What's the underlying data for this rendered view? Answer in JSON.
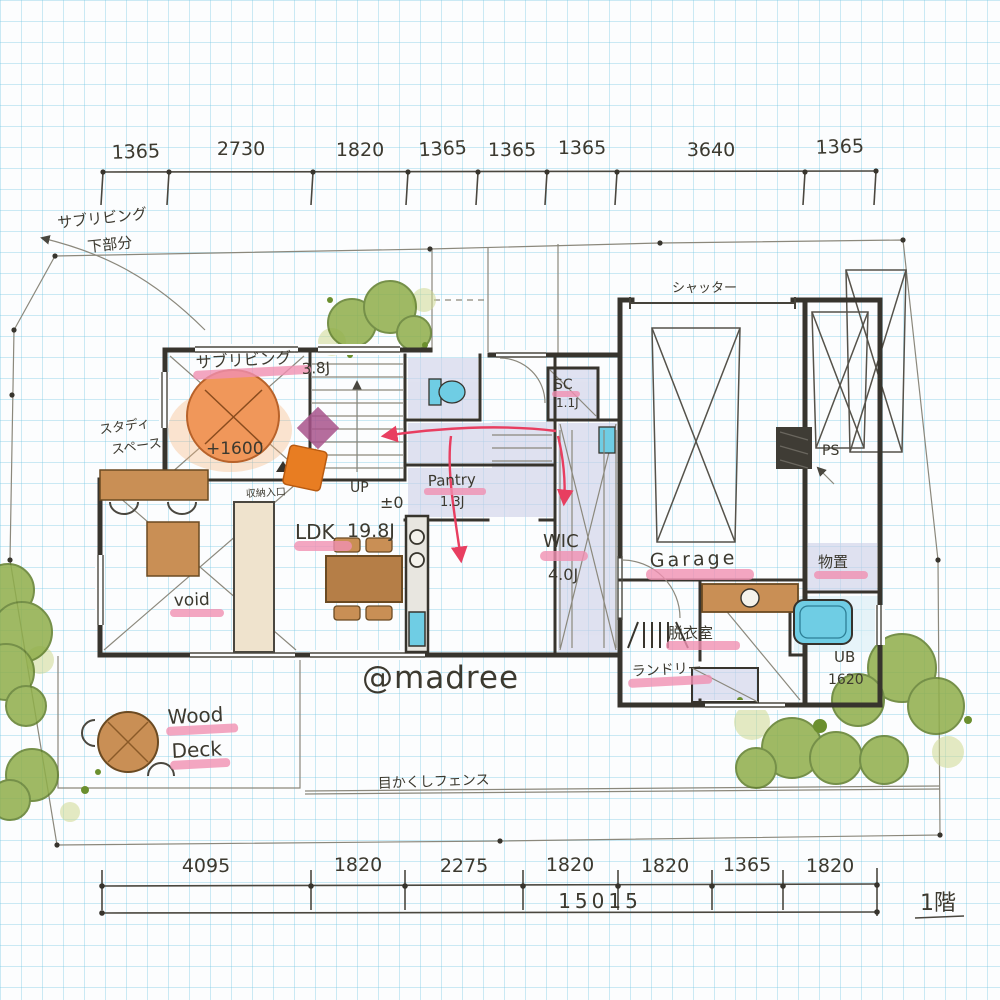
{
  "watermark": "@madree",
  "floor_label": "1階",
  "dimensions": {
    "top": [
      "1365",
      "2730",
      "1820",
      "1365",
      "1365",
      "1365",
      "3640",
      "1365"
    ],
    "bottom": [
      "4095",
      "1820",
      "2275",
      "1820",
      "1820",
      "1365",
      "1820"
    ],
    "total": "15015"
  },
  "notes": {
    "outside_note_line1": "サブリビング",
    "outside_note_line2": "下部分",
    "shutter": "シャッター",
    "fence": "目かくしフェンス",
    "entry": "収納入口",
    "up": "UP",
    "level_zero": "±0",
    "level_subliving": "+1600",
    "ps": "PS"
  },
  "rooms": {
    "sub_living": {
      "name": "サブリビング",
      "size": "3.8J"
    },
    "study_line1": "スタディ",
    "study_line2": "スペース",
    "ldk": {
      "name": "LDK",
      "size": "19.8J"
    },
    "pantry": {
      "name": "Pantry",
      "size": "1.3J"
    },
    "wic": {
      "name": "WIC",
      "size": "4.0J"
    },
    "sc": {
      "name": "SC",
      "size": "1.1J"
    },
    "garage": "Garage",
    "storage": "物置",
    "dressing": "脱衣室",
    "laundry": "ランドリー",
    "bath": {
      "name": "UB",
      "size": "1620"
    },
    "void": "void",
    "wood_deck_line1": "Wood",
    "wood_deck_line2": "Deck"
  },
  "colors": {
    "highlight_pink": "#f090b2",
    "arrow_red": "#e83e60",
    "tree_green": "#8fae4a",
    "wood_brown": "#c98f55",
    "floor_purple": "#cdd0e8",
    "fixture_cyan": "#6fcde4",
    "wall_ink": "#37342d",
    "grid_blue": "#bfe3ef",
    "accent_orange": "#f0975a"
  }
}
